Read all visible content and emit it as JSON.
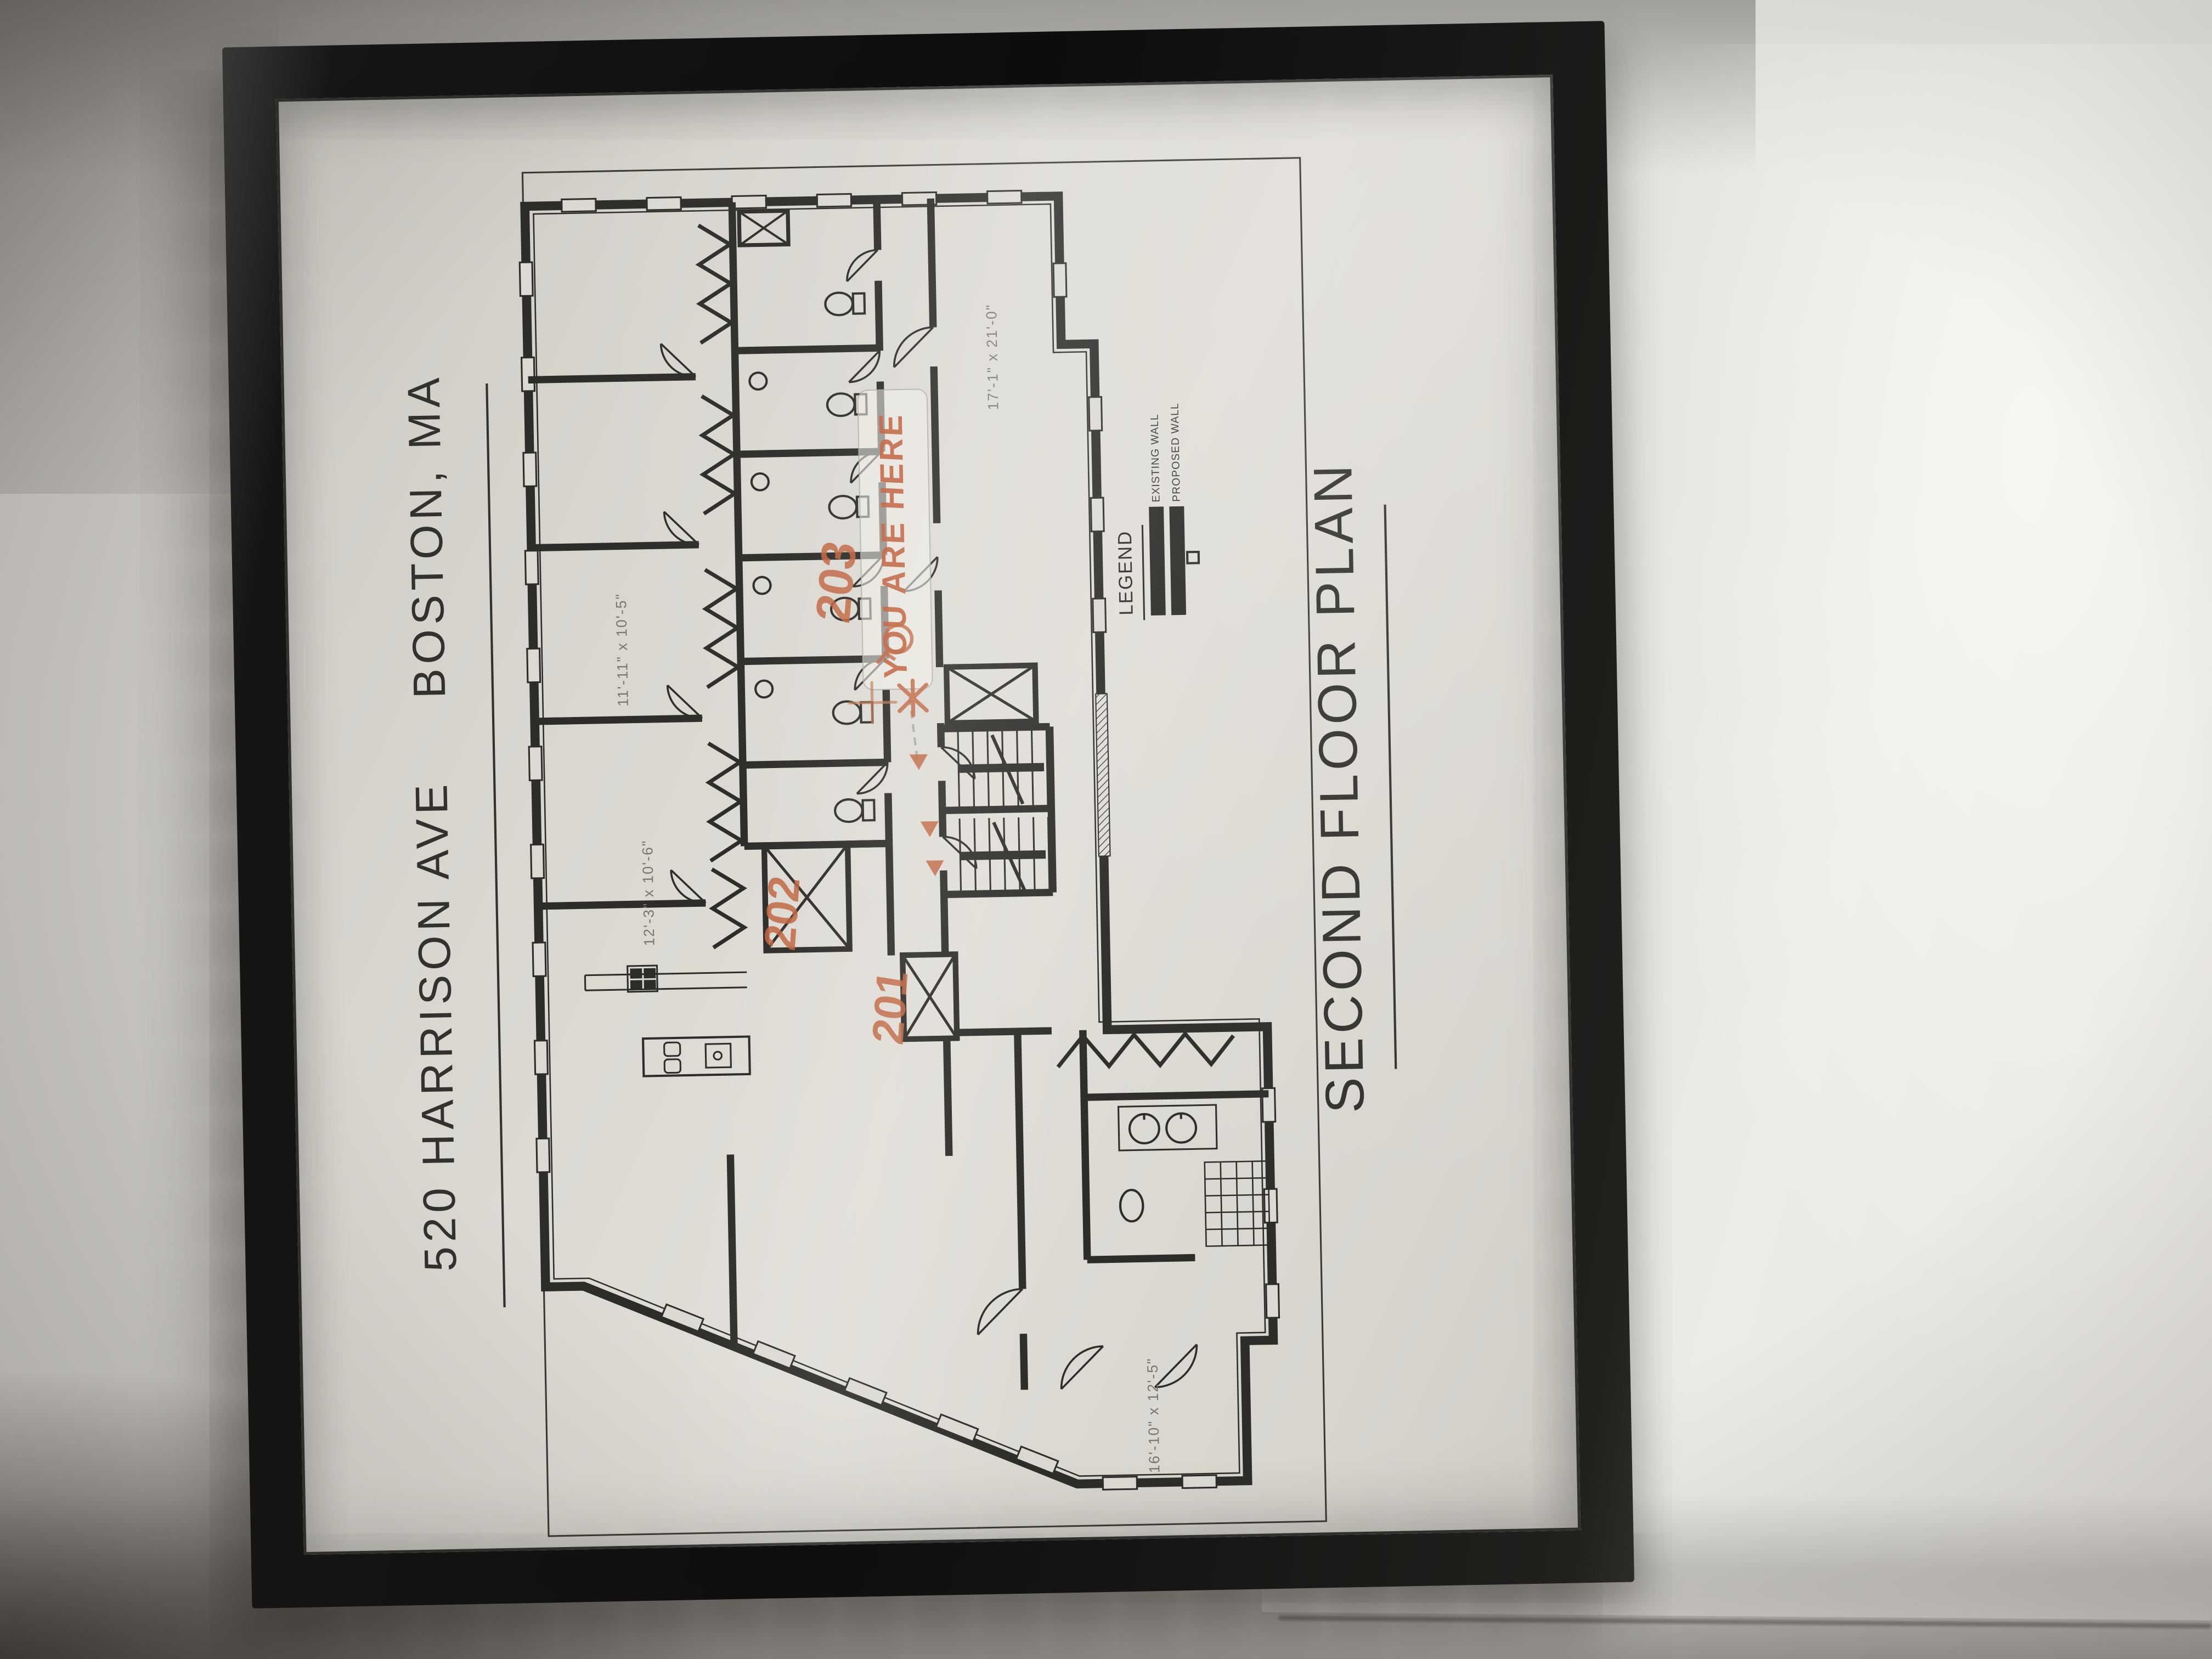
{
  "scene": {
    "wall_color": "#d6d3cf",
    "frame_color": "#161513",
    "paper_color": "#dcd9d3",
    "ink_color": "#2e2c29",
    "marker_color": "#c2613c"
  },
  "sheet": {
    "address_line": "520 HARRISON AVE",
    "city_line": "BOSTON, MA",
    "plan_title": "SECOND FLOOR PLAN",
    "legend": {
      "title": "LEGEND",
      "existing_label": "EXISTING WALL",
      "proposed_label": "PROPOSED WALL"
    },
    "dimensions": {
      "bedroom_a": "11'-11\" x 10'-5\"",
      "bedroom_b": "12'-3\" x 10'-6\"",
      "great_room": "17'-1\" x 21'-0\"",
      "wing_room": "16'-10\" x 12'-5\""
    },
    "annotations": {
      "tape_label": "YOU ARE HERE",
      "unit_201": "201",
      "unit_202": "202",
      "unit_203": "203",
      "star_mark": "*",
      "plus_mark": "+"
    }
  }
}
